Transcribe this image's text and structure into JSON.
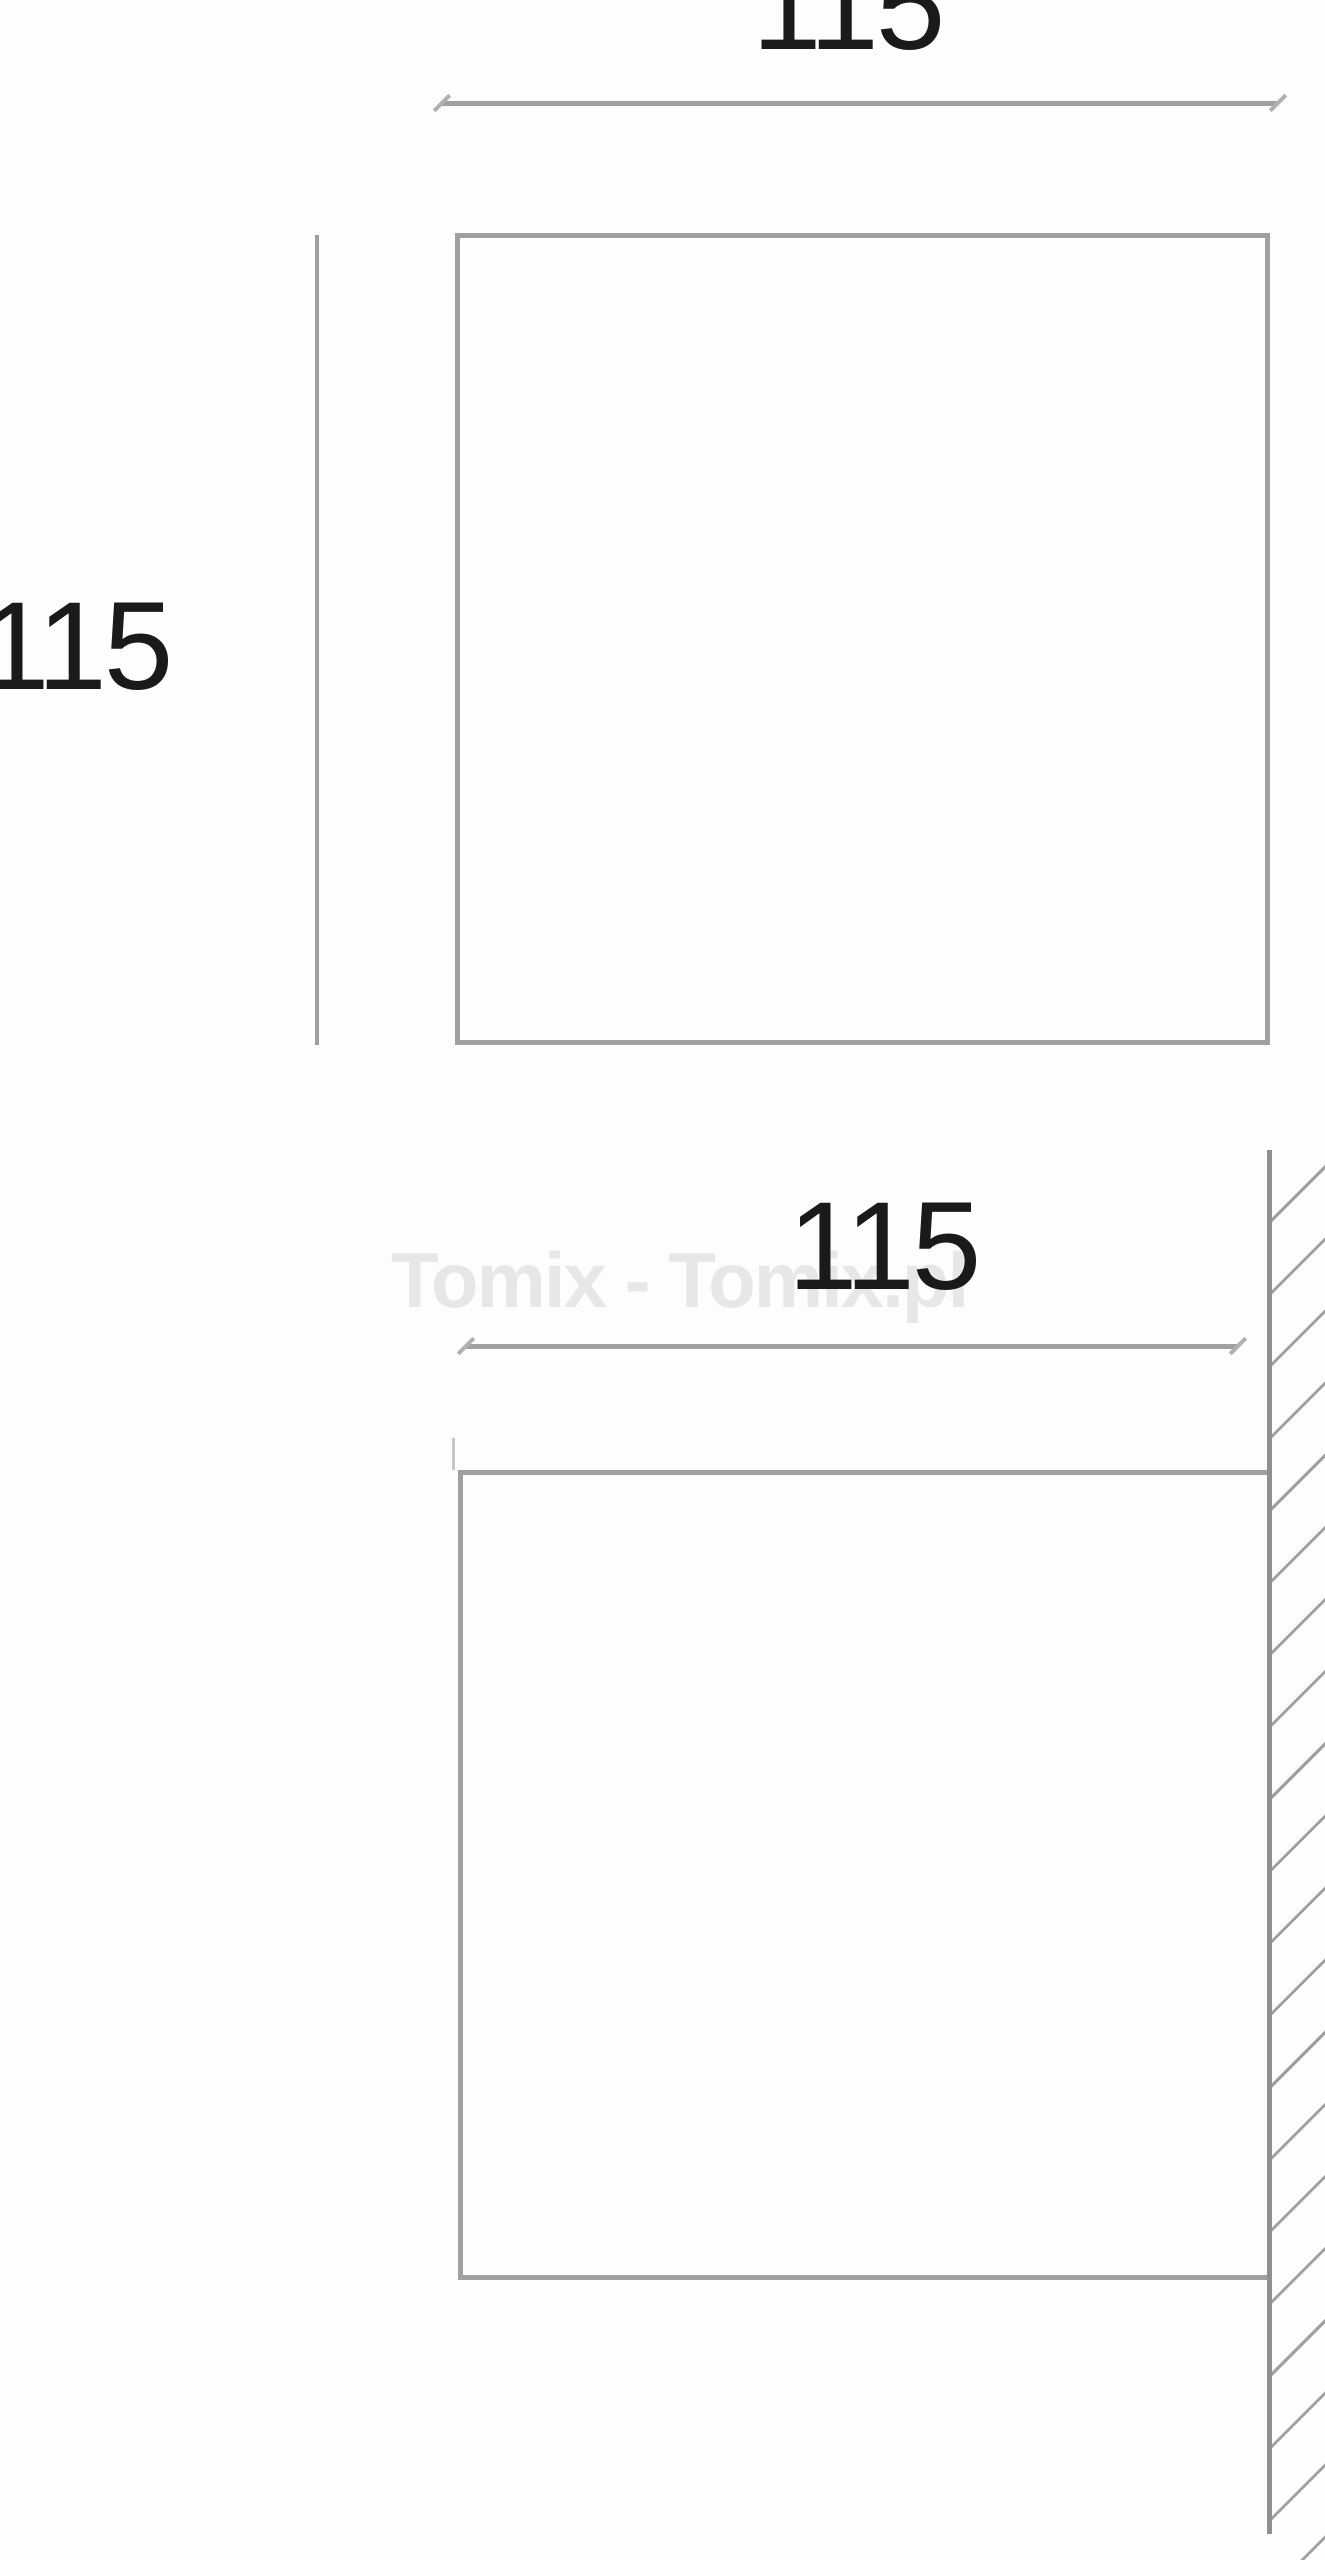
{
  "views": {
    "front": {
      "width_label": "115",
      "height_label": "115"
    },
    "side": {
      "width_label": "115"
    }
  },
  "watermark": {
    "text": "Tomix - Tomix.pl"
  },
  "colors": {
    "line_gray": "#a0a0a0",
    "wall_gray": "#8f8f8f",
    "dim_text": "#1a1a1a",
    "watermark_gray": "#e7e7e7",
    "hatch_gray": "#9f9f9f",
    "background": "#fdfdfd"
  }
}
